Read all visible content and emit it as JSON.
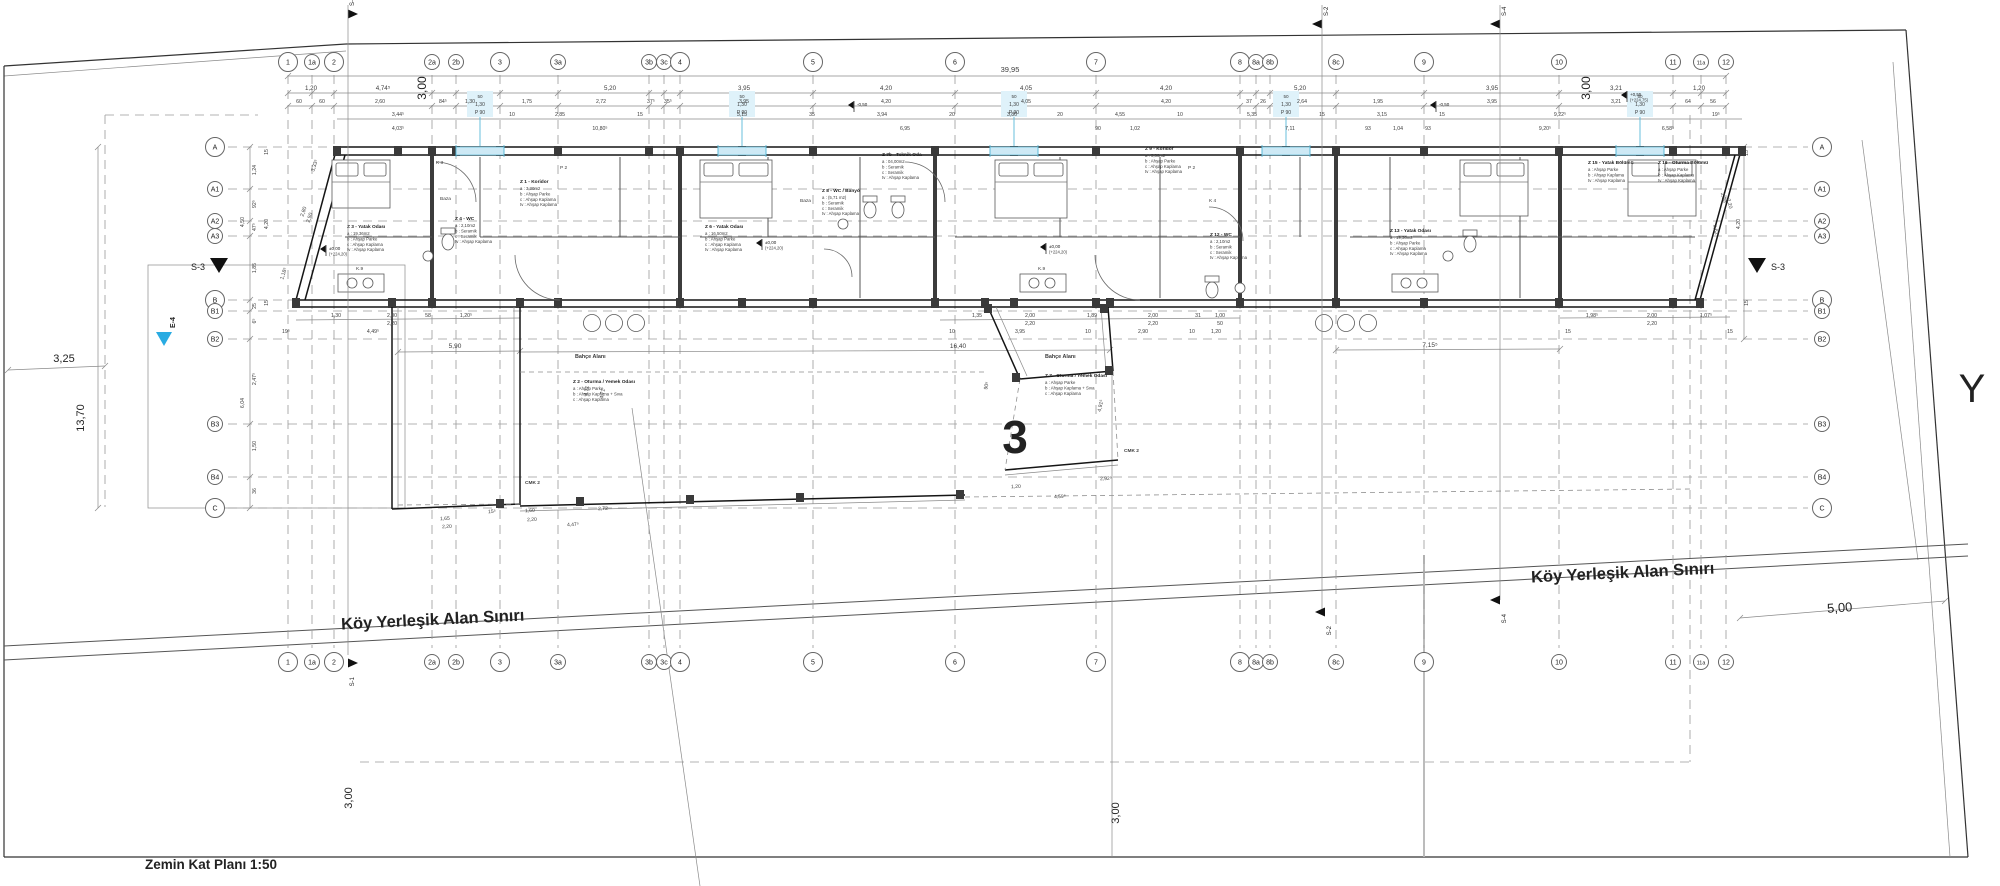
{
  "meta": {
    "title": "Zemin Kat Planı 1:50"
  },
  "labels": {
    "big_number": "3",
    "parcel_letter": "Y",
    "boundary_left": "Köy Yerleşik Alan Sınırı",
    "boundary_right": "Köy Yerleşik Alan Sınırı",
    "dim_325": "3,25",
    "dim_1370": "13,70",
    "dim_500": "5,00",
    "dim_300_bl": "3,00",
    "dim_300_bm": "3,00",
    "v300_left": "3,00",
    "v300_right": "3,00",
    "overall": "39,95",
    "dim_1640": "16,40",
    "dim_590": "5,90",
    "dim_715": "7,15⁵"
  },
  "grid": {
    "columns": [
      {
        "id": "1",
        "x": 288
      },
      {
        "id": "1a",
        "x": 312
      },
      {
        "id": "2",
        "x": 334
      },
      {
        "id": "2a",
        "x": 432
      },
      {
        "id": "2b",
        "x": 456
      },
      {
        "id": "3",
        "x": 500
      },
      {
        "id": "3a",
        "x": 558
      },
      {
        "id": "3b",
        "x": 649
      },
      {
        "id": "3c",
        "x": 664
      },
      {
        "id": "4",
        "x": 680
      },
      {
        "id": "5",
        "x": 813
      },
      {
        "id": "6",
        "x": 955
      },
      {
        "id": "7",
        "x": 1096
      },
      {
        "id": "8",
        "x": 1240
      },
      {
        "id": "8a",
        "x": 1256
      },
      {
        "id": "8b",
        "x": 1270
      },
      {
        "id": "8c",
        "x": 1336
      },
      {
        "id": "9",
        "x": 1424
      },
      {
        "id": "10",
        "x": 1559
      },
      {
        "id": "11",
        "x": 1673
      },
      {
        "id": "11a",
        "x": 1701
      },
      {
        "id": "12",
        "x": 1726
      }
    ],
    "rows": [
      {
        "id": "A",
        "y": 147
      },
      {
        "id": "A1",
        "y": 189
      },
      {
        "id": "A2",
        "y": 221
      },
      {
        "id": "A3",
        "y": 236
      },
      {
        "id": "B",
        "y": 300
      },
      {
        "id": "B1",
        "y": 311
      },
      {
        "id": "B2",
        "y": 339
      },
      {
        "id": "B3",
        "y": 424
      },
      {
        "id": "B4",
        "y": 477
      },
      {
        "id": "C",
        "y": 508
      }
    ]
  },
  "dims": {
    "tier1": [
      {
        "t": "1,20",
        "x": 311
      },
      {
        "t": "4,74⁵",
        "x": 383
      },
      {
        "t": "5,20",
        "x": 610
      },
      {
        "t": "3,95",
        "x": 744
      },
      {
        "t": "4,20",
        "x": 886
      },
      {
        "t": "4,05",
        "x": 1026
      },
      {
        "t": "4,20",
        "x": 1166
      },
      {
        "t": "5,20",
        "x": 1300
      },
      {
        "t": "3,95",
        "x": 1492
      },
      {
        "t": "3,21",
        "x": 1616
      },
      {
        "t": "1,20",
        "x": 1699
      }
    ],
    "tier2": [
      {
        "t": "60",
        "x": 299
      },
      {
        "t": "60",
        "x": 322
      },
      {
        "t": "2,60",
        "x": 380
      },
      {
        "t": "84⁵",
        "x": 443
      },
      {
        "t": "1,30",
        "x": 470
      },
      {
        "t": "1,75",
        "x": 527
      },
      {
        "t": "2,72",
        "x": 601
      },
      {
        "t": "37⁵",
        "x": 651
      },
      {
        "t": "35⁵",
        "x": 668
      },
      {
        "t": "3,95",
        "x": 744
      },
      {
        "t": "4,20",
        "x": 886
      },
      {
        "t": "4,05",
        "x": 1026
      },
      {
        "t": "4,20",
        "x": 1166
      },
      {
        "t": "37",
        "x": 1249
      },
      {
        "t": "26",
        "x": 1263
      },
      {
        "t": "2,64",
        "x": 1302
      },
      {
        "t": "1,95",
        "x": 1378
      },
      {
        "t": "3,95",
        "x": 1492
      },
      {
        "t": "3,21",
        "x": 1616
      },
      {
        "t": "64",
        "x": 1688
      },
      {
        "t": "56",
        "x": 1713
      }
    ],
    "tier3": [
      {
        "t": "3,44⁵",
        "x": 398
      },
      {
        "t": "10",
        "x": 512
      },
      {
        "t": "2,85",
        "x": 560
      },
      {
        "t": "15",
        "x": 640
      },
      {
        "t": "3,15",
        "x": 742
      },
      {
        "t": "35",
        "x": 812
      },
      {
        "t": "3,94",
        "x": 882
      },
      {
        "t": "20",
        "x": 952
      },
      {
        "t": "3,80",
        "x": 1012
      },
      {
        "t": "20",
        "x": 1060
      },
      {
        "t": "4,55",
        "x": 1120
      },
      {
        "t": "10",
        "x": 1180
      },
      {
        "t": "5,35",
        "x": 1252
      },
      {
        "t": "15",
        "x": 1322
      },
      {
        "t": "3,15",
        "x": 1382
      },
      {
        "t": "15",
        "x": 1442
      },
      {
        "t": "9,22⁵",
        "x": 1560
      },
      {
        "t": "19⁵",
        "x": 1716
      }
    ],
    "tier4": [
      {
        "t": "4,03⁵",
        "x": 398
      },
      {
        "t": "10,80⁵",
        "x": 600
      },
      {
        "t": "6,95",
        "x": 905
      },
      {
        "t": "90",
        "x": 1098
      },
      {
        "t": "1,02",
        "x": 1135
      },
      {
        "t": "7,11",
        "x": 1290
      },
      {
        "t": "93",
        "x": 1368
      },
      {
        "t": "1,04",
        "x": 1398
      },
      {
        "t": "93",
        "x": 1428
      },
      {
        "t": "9,20⁵",
        "x": 1545
      },
      {
        "t": "6,58⁵",
        "x": 1668
      }
    ],
    "bottom1": [
      {
        "t": "1,30",
        "x": 336
      },
      {
        "t": "2,00",
        "x": 392
      },
      {
        "t": "58",
        "x": 428
      },
      {
        "t": "1,20⁵",
        "x": 466
      },
      {
        "t": "1,35",
        "x": 977
      },
      {
        "t": "2,00",
        "x": 1030
      },
      {
        "t": "1,89",
        "x": 1092
      },
      {
        "t": "2,00",
        "x": 1153
      },
      {
        "t": "31",
        "x": 1198
      },
      {
        "t": "1,00",
        "x": 1220
      },
      {
        "t": "1,98⁵",
        "x": 1592
      },
      {
        "t": "2,00",
        "x": 1652
      },
      {
        "t": "1,07⁵",
        "x": 1706
      }
    ],
    "bottom2": [
      {
        "t": "2,20",
        "x": 392
      },
      {
        "t": "2,20",
        "x": 1030
      },
      {
        "t": "2,20",
        "x": 1153
      },
      {
        "t": "50",
        "x": 1220
      },
      {
        "t": "2,20",
        "x": 1652
      }
    ],
    "bottom3": [
      {
        "t": "19⁵",
        "x": 286
      },
      {
        "t": "4,49⁵",
        "x": 373
      },
      {
        "t": "10",
        "x": 952
      },
      {
        "t": "3,95",
        "x": 1020
      },
      {
        "t": "10",
        "x": 1088
      },
      {
        "t": "2,90",
        "x": 1143
      },
      {
        "t": "10",
        "x": 1192
      },
      {
        "t": "1,20",
        "x": 1216
      },
      {
        "t": "15",
        "x": 1568
      },
      {
        "t": "15",
        "x": 1730
      }
    ],
    "left_chain": [
      {
        "t": "15",
        "x": 268,
        "y": 152
      },
      {
        "t": "1,24",
        "x": 256,
        "y": 170
      },
      {
        "t": "92⁵",
        "x": 256,
        "y": 204
      },
      {
        "t": "4,50",
        "x": 244,
        "y": 222
      },
      {
        "t": "47⁵",
        "x": 256,
        "y": 227
      },
      {
        "t": "4,20",
        "x": 268,
        "y": 224
      },
      {
        "t": "1,85",
        "x": 256,
        "y": 268
      },
      {
        "t": "25",
        "x": 256,
        "y": 306
      },
      {
        "t": "15",
        "x": 268,
        "y": 303
      },
      {
        "t": "6⁵",
        "x": 256,
        "y": 321
      },
      {
        "t": "2,47⁵",
        "x": 256,
        "y": 379
      },
      {
        "t": "6,04",
        "x": 244,
        "y": 403
      },
      {
        "t": "1,50",
        "x": 256,
        "y": 446
      },
      {
        "t": "36",
        "x": 256,
        "y": 491
      }
    ],
    "right_chain": [
      {
        "t": "15",
        "x": 1748,
        "y": 153
      },
      {
        "t": "4,20",
        "x": 1740,
        "y": 224
      },
      {
        "t": "15",
        "x": 1748,
        "y": 303
      }
    ],
    "slant": [
      {
        "t": "3,33⁵",
        "x": 316,
        "y": 166,
        "r": -72
      },
      {
        "t": "2,80",
        "x": 305,
        "y": 212,
        "r": -72
      },
      {
        "t": "2,50",
        "x": 311,
        "y": 218,
        "r": -72
      },
      {
        "t": "1,18⁵",
        "x": 285,
        "y": 274,
        "r": -72
      },
      {
        "t": "4,71",
        "x": 588,
        "y": 391,
        "r": -80
      },
      {
        "t": "4,71",
        "x": 604,
        "y": 394,
        "r": -80
      },
      {
        "t": "90⁵",
        "x": 988,
        "y": 386,
        "r": -78
      },
      {
        "t": "4,91⁵",
        "x": 1102,
        "y": 406,
        "r": -78
      },
      {
        "t": "4,62",
        "x": 1714,
        "y": 230,
        "r": 75
      },
      {
        "t": "2,90",
        "x": 1722,
        "y": 198,
        "r": 75
      },
      {
        "t": "2,20",
        "x": 1728,
        "y": 204,
        "r": 75
      }
    ],
    "low_wall": [
      {
        "t": "15⁵",
        "x": 492,
        "y": 513
      },
      {
        "t": "1,60",
        "x": 530,
        "y": 512
      },
      {
        "t": "2,20",
        "x": 532,
        "y": 521
      },
      {
        "t": "2,72",
        "x": 603,
        "y": 510
      },
      {
        "t": "4,47⁵",
        "x": 573,
        "y": 526
      },
      {
        "t": "1,65",
        "x": 445,
        "y": 520
      },
      {
        "t": "2,20",
        "x": 447,
        "y": 528
      },
      {
        "t": "1,20",
        "x": 1016,
        "y": 488
      },
      {
        "t": "4,59⁵",
        "x": 1060,
        "y": 498
      },
      {
        "t": "2,92⁵",
        "x": 1106,
        "y": 480
      }
    ]
  },
  "windows": [
    {
      "x": 480,
      "tag": [
        "50",
        "1,30",
        "P 90"
      ]
    },
    {
      "x": 742,
      "tag": [
        "50",
        "1,30",
        "P 90"
      ]
    },
    {
      "x": 1014,
      "tag": [
        "50",
        "1,30",
        "P 90"
      ]
    },
    {
      "x": 1286,
      "tag": [
        "50",
        "1,30",
        "P 90"
      ]
    },
    {
      "x": 1640,
      "tag": [
        "50",
        "1,30",
        "P 90"
      ]
    }
  ],
  "rooms": [
    {
      "code": "Z 3",
      "name": "Yatak Odası",
      "x": 347,
      "y": 228,
      "items": [
        "a :  19,36m2",
        "b :  Ahşap Parke",
        "c :  Ahşap Kaplama",
        "tv :  Ahşap Kaplama"
      ]
    },
    {
      "code": "Z 1",
      "name": "Koridor",
      "x": 520,
      "y": 183,
      "items": [
        "a :  3,30m2",
        "b :  Ahşap Parke",
        "c :  Ahşap Kaplama",
        "tv :  Ahşap Kaplama"
      ]
    },
    {
      "code": "Z 4",
      "name": "WC",
      "x": 455,
      "y": 220,
      "items": [
        "a :  2,10m2",
        "b :  Seramik",
        "c :  Seramik",
        "tv :  Ahşap Kaplama"
      ]
    },
    {
      "code": "Z 2",
      "name": "Oturma / Yemek Odası",
      "x": 573,
      "y": 383,
      "items": [
        "a :  Ahşap Parke",
        "b :  Ahşap Kaplama + Sıva",
        "c :  Ahşap Kaplama"
      ]
    },
    {
      "code": "Z 6",
      "name": "Yatak Odası",
      "x": 705,
      "y": 228,
      "items": [
        "a :  16,50m2",
        "b :  Ahşap Parke",
        "c :  Ahşap Kaplama",
        "tv :  Ahşap Kaplama"
      ]
    },
    {
      "code": "Z 8",
      "name": "WC / Banyo",
      "x": 822,
      "y": 192,
      "items": [
        "a :  (5,71 m2)",
        "b :  Seramik",
        "c :  Seramik",
        "tv :  Ahşap Kaplama"
      ]
    },
    {
      "code": "Z 7b",
      "name": "Teknik Oda",
      "x": 882,
      "y": 156,
      "items": [
        "a :  04,00m2",
        "b :  Seramik",
        "c :  Seramik",
        "tv :  Ahşap Kaplama"
      ]
    },
    {
      "code": "Z 9",
      "name": "Koridor",
      "x": 1145,
      "y": 150,
      "items": [
        "a :  3,30m2",
        "b :  Ahşap Parke",
        "c :  Ahşap Kaplama",
        "tv :  Ahşap Kaplama"
      ]
    },
    {
      "code": "Z 12",
      "name": "WC",
      "x": 1210,
      "y": 236,
      "items": [
        "a :  2,10m2",
        "b :  Seramik",
        "c :  Seramik",
        "tv :  Ahşap Kaplama"
      ]
    },
    {
      "code": "Z 7",
      "name": "Oturma / Yemek Odası",
      "x": 1045,
      "y": 377,
      "items": [
        "a :  Ahşap Parke",
        "b :  Ahşap Kaplama + Sıva",
        "c :  Ahşap Kaplama"
      ]
    },
    {
      "code": "Z 13",
      "name": "Yatak Odası",
      "x": 1390,
      "y": 232,
      "items": [
        "a :  19,36m2",
        "b :  Ahşap Parke",
        "c :  Ahşap Kaplama",
        "tv :  Ahşap Kaplama"
      ]
    },
    {
      "code": "Z 15",
      "name": "Yatak Bölümü",
      "x": 1588,
      "y": 164,
      "items": [
        "a :  Ahşap Parke",
        "b :  Ahşap Kaplama",
        "tv :  Ahşap Kaplama"
      ]
    },
    {
      "code": "Z 16",
      "name": "Oturma Bölümü",
      "x": 1658,
      "y": 164,
      "items": [
        "a :  Ahşap Parke",
        "b :  Ahşap Kaplama",
        "tv :  Ahşap Kaplama"
      ]
    }
  ],
  "tags": [
    {
      "t": "Bahçe Alanı",
      "x": 575,
      "y": 358
    },
    {
      "t": "Bahçe Alanı",
      "x": 1045,
      "y": 358
    },
    {
      "t": "CMK 2",
      "x": 525,
      "y": 484
    },
    {
      "t": "CMK 2",
      "x": 1124,
      "y": 452
    },
    {
      "t": "K 3",
      "x": 436,
      "y": 164
    },
    {
      "t": "K 4",
      "x": 1209,
      "y": 202
    },
    {
      "t": "Baza",
      "x": 440,
      "y": 200
    },
    {
      "t": "Baza",
      "x": 800,
      "y": 202
    },
    {
      "t": "P 2",
      "x": 560,
      "y": 169
    },
    {
      "t": "P 2",
      "x": 1188,
      "y": 169
    },
    {
      "t": "K.9",
      "x": 356,
      "y": 270
    },
    {
      "t": "K.9",
      "x": 1038,
      "y": 270
    }
  ],
  "elevations": [
    {
      "a": "±0,00",
      "b": "(+224,20)",
      "x": 327,
      "y": 252
    },
    {
      "a": "±0,00",
      "b": "(+224,20)",
      "x": 763,
      "y": 246
    },
    {
      "a": "±0,00",
      "b": "(+224,20)",
      "x": 1047,
      "y": 250
    },
    {
      "a": "-0,50",
      "b": "",
      "x": 855,
      "y": 108
    },
    {
      "a": "-0,50",
      "b": "",
      "x": 1437,
      "y": 108
    },
    {
      "a": "+0,55",
      "b": "(+224,75)",
      "x": 1628,
      "y": 98
    }
  ],
  "sections": [
    {
      "id": "S-1",
      "x": 348,
      "y": 14,
      "dir": "r",
      "v1": 5,
      "v2": 655
    },
    {
      "id": "S-1",
      "x": 348,
      "y": 663,
      "dir": "r",
      "v1": 0,
      "v2": 0
    },
    {
      "id": "S-2",
      "x": 1322,
      "y": 24,
      "dir": "l",
      "v1": 5,
      "v2": 612
    },
    {
      "id": "S-2",
      "x": 1325,
      "y": 612,
      "dir": "l",
      "v1": 0,
      "v2": 0
    },
    {
      "id": "S-4",
      "x": 1500,
      "y": 24,
      "dir": "l",
      "v1": 5,
      "v2": 600
    },
    {
      "id": "S-4",
      "x": 1500,
      "y": 600,
      "dir": "l",
      "v1": 0,
      "v2": 0
    }
  ],
  "s3_markers": [
    {
      "id": "S-3",
      "x": 219,
      "y": 258,
      "side": "left"
    },
    {
      "id": "S-3",
      "x": 1757,
      "y": 258,
      "side": "right"
    }
  ],
  "e4_marker": {
    "id": "E-4",
    "x": 164,
    "y": 332
  }
}
